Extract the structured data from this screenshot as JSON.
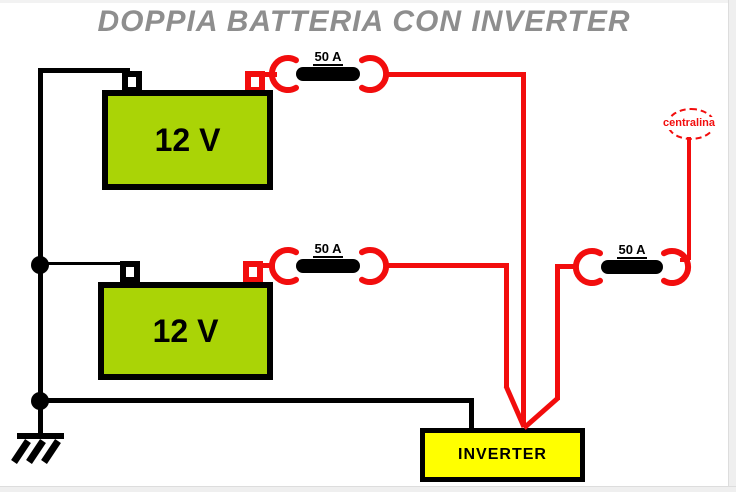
{
  "title": "DOPPIA BATTERIA CON INVERTER",
  "battery1": {
    "label": "12 V"
  },
  "battery2": {
    "label": "12 V"
  },
  "fuse1": {
    "label": "50 A"
  },
  "fuse2": {
    "label": "50 A"
  },
  "fuse3": {
    "label": "50 A"
  },
  "centralina": {
    "label": "centralina"
  },
  "inverter": {
    "label": "INVERTER"
  },
  "colors": {
    "battery_fill": "#aad406",
    "positive_wire": "#f20d0d",
    "negative_wire": "#000000",
    "inverter_fill": "#ffff00",
    "title_text": "#8e8e8e"
  }
}
